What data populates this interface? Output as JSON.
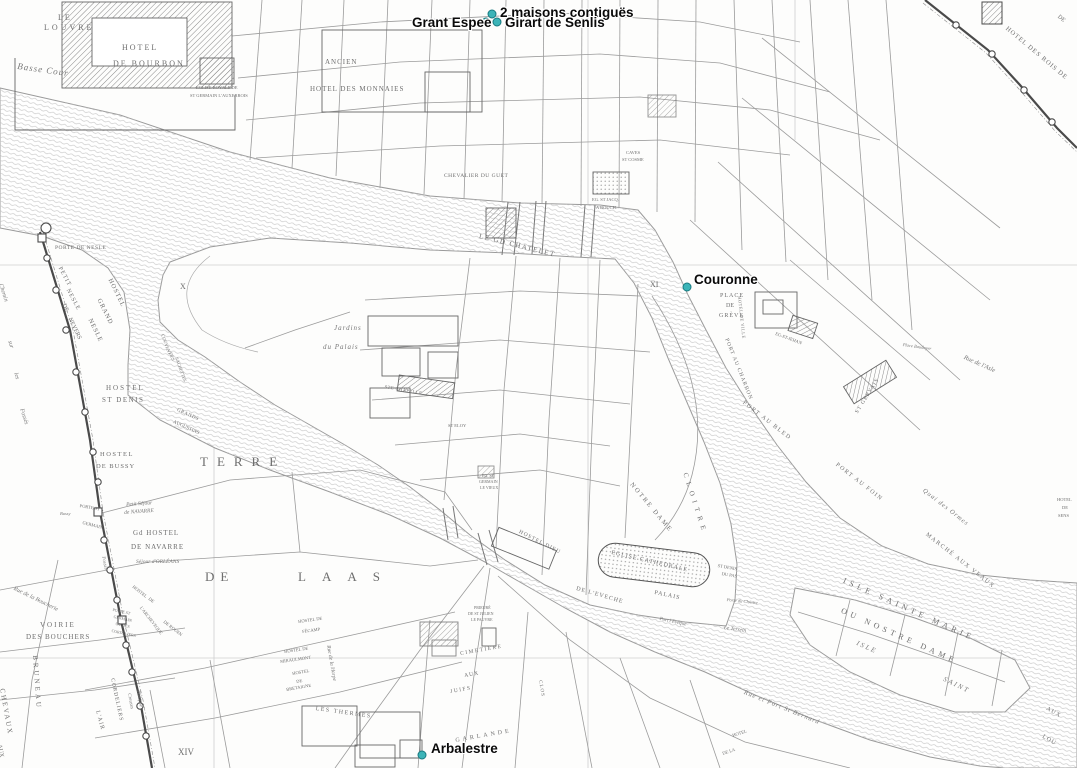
{
  "annotations": {
    "dot_color": "#3cb4b8",
    "dot_border": "#187a80",
    "items": [
      {
        "label": "2 maisons contiguës",
        "dot": {
          "x": 492,
          "y": 14
        },
        "pos": {
          "x": 500,
          "y": 5
        }
      },
      {
        "label": "Grant Espee",
        "dot": {
          "x": 486,
          "y": 22
        },
        "pos": {
          "x": 412,
          "y": 15
        }
      },
      {
        "label": "Girart de Senlis",
        "dot": {
          "x": 497,
          "y": 22
        },
        "pos": {
          "x": 505,
          "y": 15
        }
      },
      {
        "label": "Couronne",
        "dot": {
          "x": 687,
          "y": 287
        },
        "pos": {
          "x": 694,
          "y": 272
        }
      },
      {
        "label": "Arbalestre",
        "dot": {
          "x": 422,
          "y": 755
        },
        "pos": {
          "x": 431,
          "y": 741
        }
      }
    ]
  },
  "map": {
    "labels": [
      {
        "t": "LE",
        "x": 58,
        "y": 14,
        "s": 8,
        "ls": 2
      },
      {
        "t": "LOUVRE",
        "x": 44,
        "y": 24,
        "s": 8,
        "ls": 3
      },
      {
        "t": "Basse Cour",
        "x": 18,
        "y": 62,
        "s": 9,
        "ls": 1,
        "i": 1,
        "r": 8
      },
      {
        "t": "HOTEL",
        "x": 122,
        "y": 44,
        "s": 8,
        "ls": 2
      },
      {
        "t": "DE BOURBON",
        "x": 113,
        "y": 60,
        "s": 8,
        "ls": 2
      },
      {
        "t": "EGLISE ROYALE DE",
        "x": 196,
        "y": 86,
        "s": 4.5
      },
      {
        "t": "ST GERMAIN L'AUXERROIS",
        "x": 190,
        "y": 94,
        "s": 4.5
      },
      {
        "t": "ANCIEN",
        "x": 325,
        "y": 59,
        "s": 7,
        "ls": 1
      },
      {
        "t": "HOTEL DES MONNAIES",
        "x": 310,
        "y": 86,
        "s": 7,
        "ls": 1
      },
      {
        "t": "CHEVALIER DU GUET",
        "x": 444,
        "y": 174,
        "s": 5.5,
        "ls": 0.5
      },
      {
        "t": "LE GD CHATELET",
        "x": 480,
        "y": 233,
        "s": 7,
        "ls": 1.5,
        "r": 14
      },
      {
        "t": "EG. ST JACQ.",
        "x": 592,
        "y": 198,
        "s": 4.5
      },
      {
        "t": "A BOUCH.",
        "x": 596,
        "y": 206,
        "s": 4.5
      },
      {
        "t": "CAVES",
        "x": 626,
        "y": 151,
        "s": 4.5
      },
      {
        "t": "ST COSME",
        "x": 622,
        "y": 158,
        "s": 4.5
      },
      {
        "t": "HOTEL DES ROIS DE",
        "x": 1008,
        "y": 26,
        "s": 6.5,
        "ls": 1,
        "r": 40
      },
      {
        "t": "DE",
        "x": 1060,
        "y": 14,
        "s": 6,
        "r": 40
      },
      {
        "t": "PLACE",
        "x": 720,
        "y": 293,
        "s": 6,
        "ls": 1
      },
      {
        "t": "DE",
        "x": 726,
        "y": 303,
        "s": 6
      },
      {
        "t": "GRÈVE",
        "x": 719,
        "y": 313,
        "s": 6,
        "ls": 1
      },
      {
        "t": "HOTEL DE VILLE",
        "x": 741,
        "y": 296,
        "s": 4.5,
        "ls": 0.5,
        "r": 84
      },
      {
        "t": "EG-ST-JEHAN",
        "x": 776,
        "y": 332,
        "s": 4.5,
        "r": 20
      },
      {
        "t": "ST GERVAIS",
        "x": 855,
        "y": 412,
        "s": 5.5,
        "ls": 1,
        "r": -58
      },
      {
        "t": "PORT AU CHARBON",
        "x": 728,
        "y": 338,
        "s": 5.5,
        "ls": 1,
        "r": 68
      },
      {
        "t": "PORT AU BLED",
        "x": 745,
        "y": 400,
        "s": 6,
        "ls": 1.5,
        "r": 38
      },
      {
        "t": "PORT AU FOIN",
        "x": 838,
        "y": 462,
        "s": 6,
        "ls": 1.5,
        "r": 38
      },
      {
        "t": "Quai des Ormes",
        "x": 925,
        "y": 488,
        "s": 6.5,
        "ls": 1,
        "i": 1,
        "r": 38
      },
      {
        "t": "MARCHÉ AUX VEAUX",
        "x": 928,
        "y": 532,
        "s": 6,
        "ls": 1.5,
        "r": 38
      },
      {
        "t": "Rue de l'Asle",
        "x": 965,
        "y": 355,
        "s": 6.5,
        "i": 1,
        "r": 24
      },
      {
        "t": "Place Baudoyer",
        "x": 903,
        "y": 343,
        "s": 4.5,
        "i": 1,
        "r": 8
      },
      {
        "t": "HOTEL",
        "x": 1057,
        "y": 498,
        "s": 4.5
      },
      {
        "t": "DE",
        "x": 1062,
        "y": 506,
        "s": 4.5
      },
      {
        "t": "SENS",
        "x": 1058,
        "y": 514,
        "s": 4.5
      },
      {
        "t": "Rue et Port St Bernard",
        "x": 745,
        "y": 690,
        "s": 6.5,
        "ls": 1,
        "i": 1,
        "r": 22
      },
      {
        "t": "AUX",
        "x": 1048,
        "y": 706,
        "s": 6,
        "ls": 1,
        "r": 30
      },
      {
        "t": "LOU",
        "x": 1044,
        "y": 734,
        "s": 6,
        "ls": 1,
        "r": 30
      },
      {
        "t": "Jardins",
        "x": 334,
        "y": 325,
        "s": 7,
        "ls": 1,
        "i": 1
      },
      {
        "t": "du Palais",
        "x": 323,
        "y": 344,
        "s": 7,
        "ls": 1,
        "i": 1
      },
      {
        "t": "STE CHAPELLE",
        "x": 385,
        "y": 385,
        "s": 4.5,
        "ls": 0.5,
        "r": 10
      },
      {
        "t": "ST ELOY",
        "x": 448,
        "y": 424,
        "s": 4.5
      },
      {
        "t": "EG. ST",
        "x": 482,
        "y": 474,
        "s": 4
      },
      {
        "t": "GERMAIN",
        "x": 479,
        "y": 480,
        "s": 4
      },
      {
        "t": "LE VIEUX",
        "x": 480,
        "y": 486,
        "s": 4
      },
      {
        "t": "HOSTEL DIEU",
        "x": 520,
        "y": 530,
        "s": 5.5,
        "ls": 1,
        "r": 27
      },
      {
        "t": "NOTRE DAME",
        "x": 633,
        "y": 482,
        "s": 6.5,
        "ls": 2,
        "r": 50
      },
      {
        "t": "CLOITRE",
        "x": 688,
        "y": 472,
        "s": 7,
        "ls": 5,
        "r": 72
      },
      {
        "t": "EGLISE CATHEDRALE",
        "x": 612,
        "y": 550,
        "s": 6,
        "ls": 1,
        "r": 13
      },
      {
        "t": "ST DENIS",
        "x": 718,
        "y": 564,
        "s": 4.5,
        "r": 10
      },
      {
        "t": "DU PAS",
        "x": 722,
        "y": 572,
        "s": 4.5,
        "r": 10
      },
      {
        "t": "PALAIS",
        "x": 655,
        "y": 590,
        "s": 6,
        "ls": 1,
        "r": 12
      },
      {
        "t": "DE L'EVECHE",
        "x": 577,
        "y": 586,
        "s": 6,
        "ls": 1,
        "r": 16
      },
      {
        "t": "Porte du Cloistre",
        "x": 727,
        "y": 598,
        "s": 4.5,
        "i": 1,
        "r": 6
      },
      {
        "t": "Port l'Evêque",
        "x": 660,
        "y": 617,
        "s": 5,
        "i": 1,
        "r": 12
      },
      {
        "t": "Le Terrein",
        "x": 724,
        "y": 626,
        "s": 5.5,
        "i": 1,
        "r": 8
      },
      {
        "t": "X",
        "x": 180,
        "y": 283,
        "s": 8
      },
      {
        "t": "XI",
        "x": 650,
        "y": 281,
        "s": 8
      },
      {
        "t": "XIV",
        "x": 178,
        "y": 748,
        "s": 9
      },
      {
        "t": "ISLE  SAINTE  MARIE",
        "x": 845,
        "y": 577,
        "s": 8,
        "ls": 4,
        "r": 24
      },
      {
        "t": "OU  NOSTRE  DAME",
        "x": 843,
        "y": 607,
        "s": 8,
        "ls": 4,
        "r": 24
      },
      {
        "t": "ISLE",
        "x": 858,
        "y": 640,
        "s": 7,
        "ls": 2,
        "i": 1,
        "r": 24
      },
      {
        "t": "SAINT",
        "x": 945,
        "y": 676,
        "s": 7,
        "ls": 2,
        "i": 1,
        "r": 26
      },
      {
        "t": "PORTE DE NESLE",
        "x": 55,
        "y": 246,
        "s": 5.5,
        "ls": 0.5
      },
      {
        "t": "Chemin",
        "x": 3,
        "y": 283,
        "s": 6,
        "i": 1,
        "r": 72
      },
      {
        "t": "sur",
        "x": 12,
        "y": 340,
        "s": 6,
        "i": 1,
        "r": 72
      },
      {
        "t": "les",
        "x": 18,
        "y": 372,
        "s": 6,
        "i": 1,
        "r": 72
      },
      {
        "t": "Fossés",
        "x": 24,
        "y": 408,
        "s": 6,
        "i": 1,
        "r": 72
      },
      {
        "t": "PETIT",
        "x": 62,
        "y": 266,
        "s": 6,
        "ls": 1,
        "r": 62
      },
      {
        "t": "NESLE",
        "x": 70,
        "y": 288,
        "s": 6,
        "ls": 1,
        "r": 62
      },
      {
        "t": "HOSTEL",
        "x": 112,
        "y": 278,
        "s": 6.5,
        "ls": 1,
        "r": 64
      },
      {
        "t": "GRAND",
        "x": 101,
        "y": 298,
        "s": 6.5,
        "ls": 1,
        "r": 64
      },
      {
        "t": "NESLE",
        "x": 92,
        "y": 318,
        "s": 6.5,
        "ls": 1,
        "r": 64
      },
      {
        "t": "DE",
        "x": 66,
        "y": 303,
        "s": 6,
        "r": 64
      },
      {
        "t": "NEVERS",
        "x": 72,
        "y": 317,
        "s": 6,
        "r": 64
      },
      {
        "t": "COUVENT",
        "x": 164,
        "y": 334,
        "s": 4.5,
        "r": 70
      },
      {
        "t": "DES",
        "x": 172,
        "y": 352,
        "s": 4.5,
        "r": 70
      },
      {
        "t": "SACHETTES",
        "x": 178,
        "y": 357,
        "s": 4.5,
        "r": 70
      },
      {
        "t": "HOSTEL",
        "x": 106,
        "y": 385,
        "s": 7,
        "ls": 2
      },
      {
        "t": "ST DENIS",
        "x": 102,
        "y": 397,
        "s": 7,
        "ls": 1.5
      },
      {
        "t": "GRANDS",
        "x": 178,
        "y": 408,
        "s": 5,
        "ls": 0.5,
        "r": 24
      },
      {
        "t": "AUGUSTINS",
        "x": 174,
        "y": 420,
        "s": 5,
        "r": 24
      },
      {
        "t": "HOSTEL",
        "x": 100,
        "y": 452,
        "s": 6.5,
        "ls": 1.5
      },
      {
        "t": "DE BUSSY",
        "x": 96,
        "y": 464,
        "s": 6.5,
        "ls": 1
      },
      {
        "t": "TERRE",
        "x": 200,
        "y": 455,
        "s": 13,
        "ls": 9
      },
      {
        "t": "DE",
        "x": 205,
        "y": 570,
        "s": 13,
        "ls": 6
      },
      {
        "t": "LAAS",
        "x": 298,
        "y": 570,
        "s": 13,
        "ls": 16
      },
      {
        "t": "PORTE ST",
        "x": 80,
        "y": 504,
        "s": 4.5,
        "r": 10
      },
      {
        "t": "GERMAIN",
        "x": 83,
        "y": 521,
        "s": 4.5,
        "r": 14
      },
      {
        "t": "Bussy",
        "x": 60,
        "y": 512,
        "s": 4.5,
        "i": 1
      },
      {
        "t": "Petit Séjour",
        "x": 126,
        "y": 503,
        "s": 5.5,
        "i": 1,
        "r": -4
      },
      {
        "t": "de NAVARRE",
        "x": 124,
        "y": 511,
        "s": 5.5,
        "i": 1,
        "r": -4
      },
      {
        "t": "Gd HOSTEL",
        "x": 133,
        "y": 530,
        "s": 7,
        "ls": 1
      },
      {
        "t": "DE NAVARRE",
        "x": 131,
        "y": 544,
        "s": 7,
        "ls": 1
      },
      {
        "t": "Séjour d'ORLÉANS",
        "x": 136,
        "y": 560,
        "s": 5.5,
        "i": 1
      },
      {
        "t": "Fossés",
        "x": 105,
        "y": 556,
        "s": 5,
        "i": 1,
        "r": 78
      },
      {
        "t": "Rue de la Boucherie",
        "x": 15,
        "y": 586,
        "s": 6,
        "i": 1,
        "r": 26
      },
      {
        "t": "VOIRIE",
        "x": 40,
        "y": 622,
        "s": 7,
        "ls": 2
      },
      {
        "t": "DES BOUCHERS",
        "x": 26,
        "y": 634,
        "s": 7,
        "ls": 1
      },
      {
        "t": "BRUNEAU",
        "x": 38,
        "y": 655,
        "s": 7,
        "ls": 3,
        "r": 86
      },
      {
        "t": "CHEVAUX",
        "x": 5,
        "y": 688,
        "s": 7,
        "ls": 2,
        "r": 80
      },
      {
        "t": "AUX",
        "x": 2,
        "y": 744,
        "s": 6,
        "r": 80
      },
      {
        "t": "PORTE ST",
        "x": 113,
        "y": 608,
        "s": 4,
        "r": 12
      },
      {
        "t": "GERMAIN",
        "x": 114,
        "y": 615,
        "s": 4,
        "r": 12
      },
      {
        "t": "OU DES",
        "x": 116,
        "y": 622,
        "s": 4,
        "r": 12
      },
      {
        "t": "CORDELIERS",
        "x": 112,
        "y": 629,
        "s": 4,
        "r": 12
      },
      {
        "t": "HOSTEL",
        "x": 134,
        "y": 585,
        "s": 4.5,
        "r": 38
      },
      {
        "t": "DE",
        "x": 150,
        "y": 597,
        "s": 4.5,
        "r": 38
      },
      {
        "t": "L'ARCHEVEQUE",
        "x": 142,
        "y": 606,
        "s": 4.5,
        "r": 52
      },
      {
        "t": "DE ROUEN",
        "x": 165,
        "y": 620,
        "s": 4.5,
        "r": 38
      },
      {
        "t": "Philippe",
        "x": 140,
        "y": 690,
        "s": 5,
        "i": 1,
        "r": 80
      },
      {
        "t": "Creuses",
        "x": 131,
        "y": 693,
        "s": 5,
        "i": 1,
        "r": 80
      },
      {
        "t": "L'AIR",
        "x": 100,
        "y": 710,
        "s": 6,
        "ls": 1,
        "r": 75
      },
      {
        "t": "CORDELIERS",
        "x": 114,
        "y": 678,
        "s": 5.5,
        "ls": 1,
        "r": 78
      },
      {
        "t": "HOSTEL DE",
        "x": 298,
        "y": 620,
        "s": 4.5,
        "r": -8
      },
      {
        "t": "FÉCAMP",
        "x": 302,
        "y": 630,
        "s": 4.5,
        "r": -8
      },
      {
        "t": "HOSTEL DE",
        "x": 284,
        "y": 650,
        "s": 4.5,
        "r": -8
      },
      {
        "t": "MIRAULMONT",
        "x": 280,
        "y": 660,
        "s": 4.5,
        "r": -8
      },
      {
        "t": "HOSTEL",
        "x": 292,
        "y": 672,
        "s": 4.5,
        "r": -10
      },
      {
        "t": "DE",
        "x": 296,
        "y": 680,
        "s": 4.5,
        "r": -10
      },
      {
        "t": "BRETAIGNE",
        "x": 286,
        "y": 688,
        "s": 4.5,
        "r": -10
      },
      {
        "t": "Rue de la Harpe",
        "x": 330,
        "y": 645,
        "s": 5.5,
        "i": 1,
        "r": 80
      },
      {
        "t": "LES THERMES",
        "x": 316,
        "y": 706,
        "s": 6,
        "ls": 1.5,
        "r": 8
      },
      {
        "t": "CIMETIERE",
        "x": 460,
        "y": 652,
        "s": 5.5,
        "ls": 1.5,
        "r": -10
      },
      {
        "t": "AUX",
        "x": 464,
        "y": 674,
        "s": 5.5,
        "ls": 1,
        "r": -10
      },
      {
        "t": "JUIFS",
        "x": 450,
        "y": 690,
        "s": 5.5,
        "ls": 1.5,
        "r": -10
      },
      {
        "t": "GARLANDE",
        "x": 455,
        "y": 738,
        "s": 6,
        "ls": 3,
        "r": -10
      },
      {
        "t": "CLOS",
        "x": 542,
        "y": 680,
        "s": 5,
        "ls": 1,
        "r": 80
      },
      {
        "t": "PRIEURÉ",
        "x": 474,
        "y": 606,
        "s": 4
      },
      {
        "t": "DE ST JULIEN",
        "x": 468,
        "y": 612,
        "s": 4
      },
      {
        "t": "LE PAUVRE",
        "x": 471,
        "y": 618,
        "s": 4
      },
      {
        "t": "HOTEL",
        "x": 732,
        "y": 734,
        "s": 4.5,
        "r": -18
      },
      {
        "t": "DE LA",
        "x": 722,
        "y": 752,
        "s": 4.5,
        "r": -18
      }
    ]
  }
}
